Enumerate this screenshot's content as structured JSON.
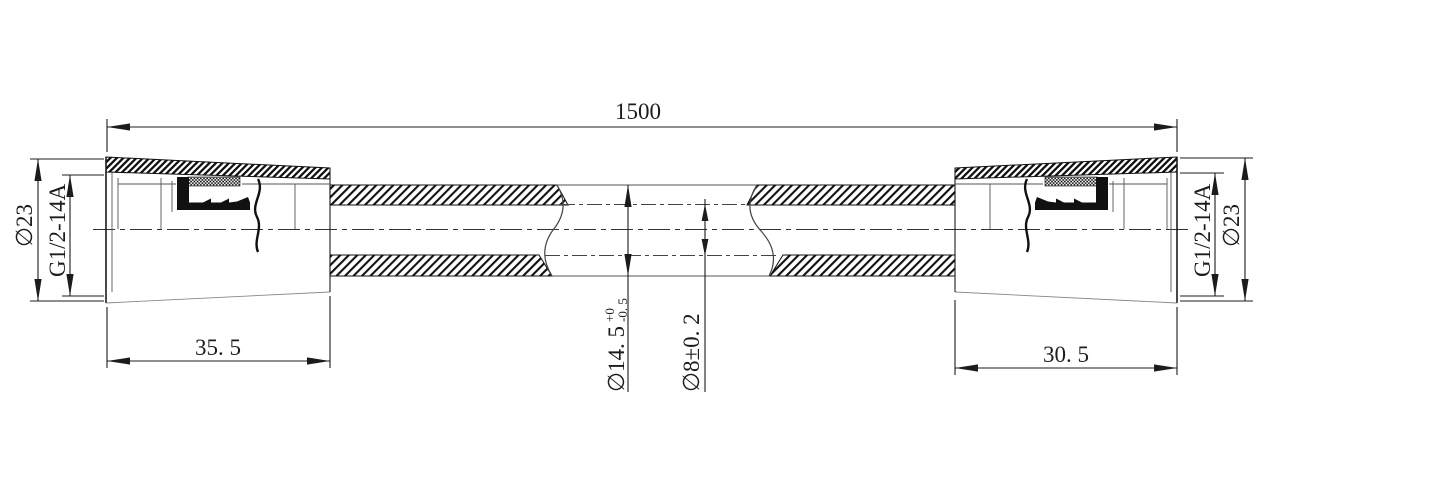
{
  "drawing": {
    "type": "engineering-drawing",
    "subject": "flexible hose with two end fittings, half-section views",
    "background_color": "#ffffff",
    "line_color": "#1c1c1c",
    "dimensions": {
      "overall_length": "1500",
      "left_fitting": {
        "length": "35. 5",
        "outer_diameter": "∅23",
        "thread": "G1/2-14A"
      },
      "right_fitting": {
        "length": "30. 5",
        "outer_diameter": "∅23",
        "thread": "G1/2-14A"
      },
      "hose": {
        "outer_diameter": "∅14. 5",
        "outer_diameter_tolerance_upper": "+0",
        "outer_diameter_tolerance_lower": "-0. 5",
        "inner_diameter": "∅8±0. 2"
      }
    }
  }
}
